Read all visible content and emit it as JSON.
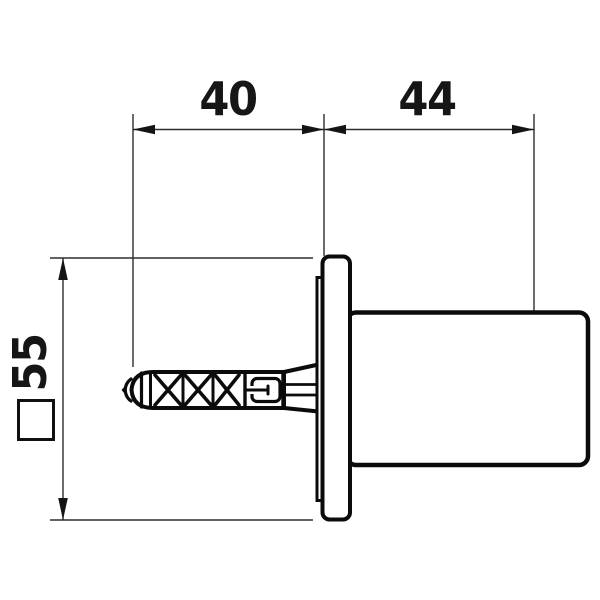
{
  "drawing": {
    "kind": "technical dimension drawing",
    "view": "side view of wall-mounted cylindrical fixture with expansion wall plug"
  },
  "dimensions": {
    "d40": "40",
    "d44": "44",
    "d55": "55",
    "d55_symbol": "square"
  },
  "colors": {
    "background": "#ffffff",
    "part_outline": "#0b0b0b",
    "dimension_lines": "#2e2e2e",
    "text": "#161616"
  }
}
